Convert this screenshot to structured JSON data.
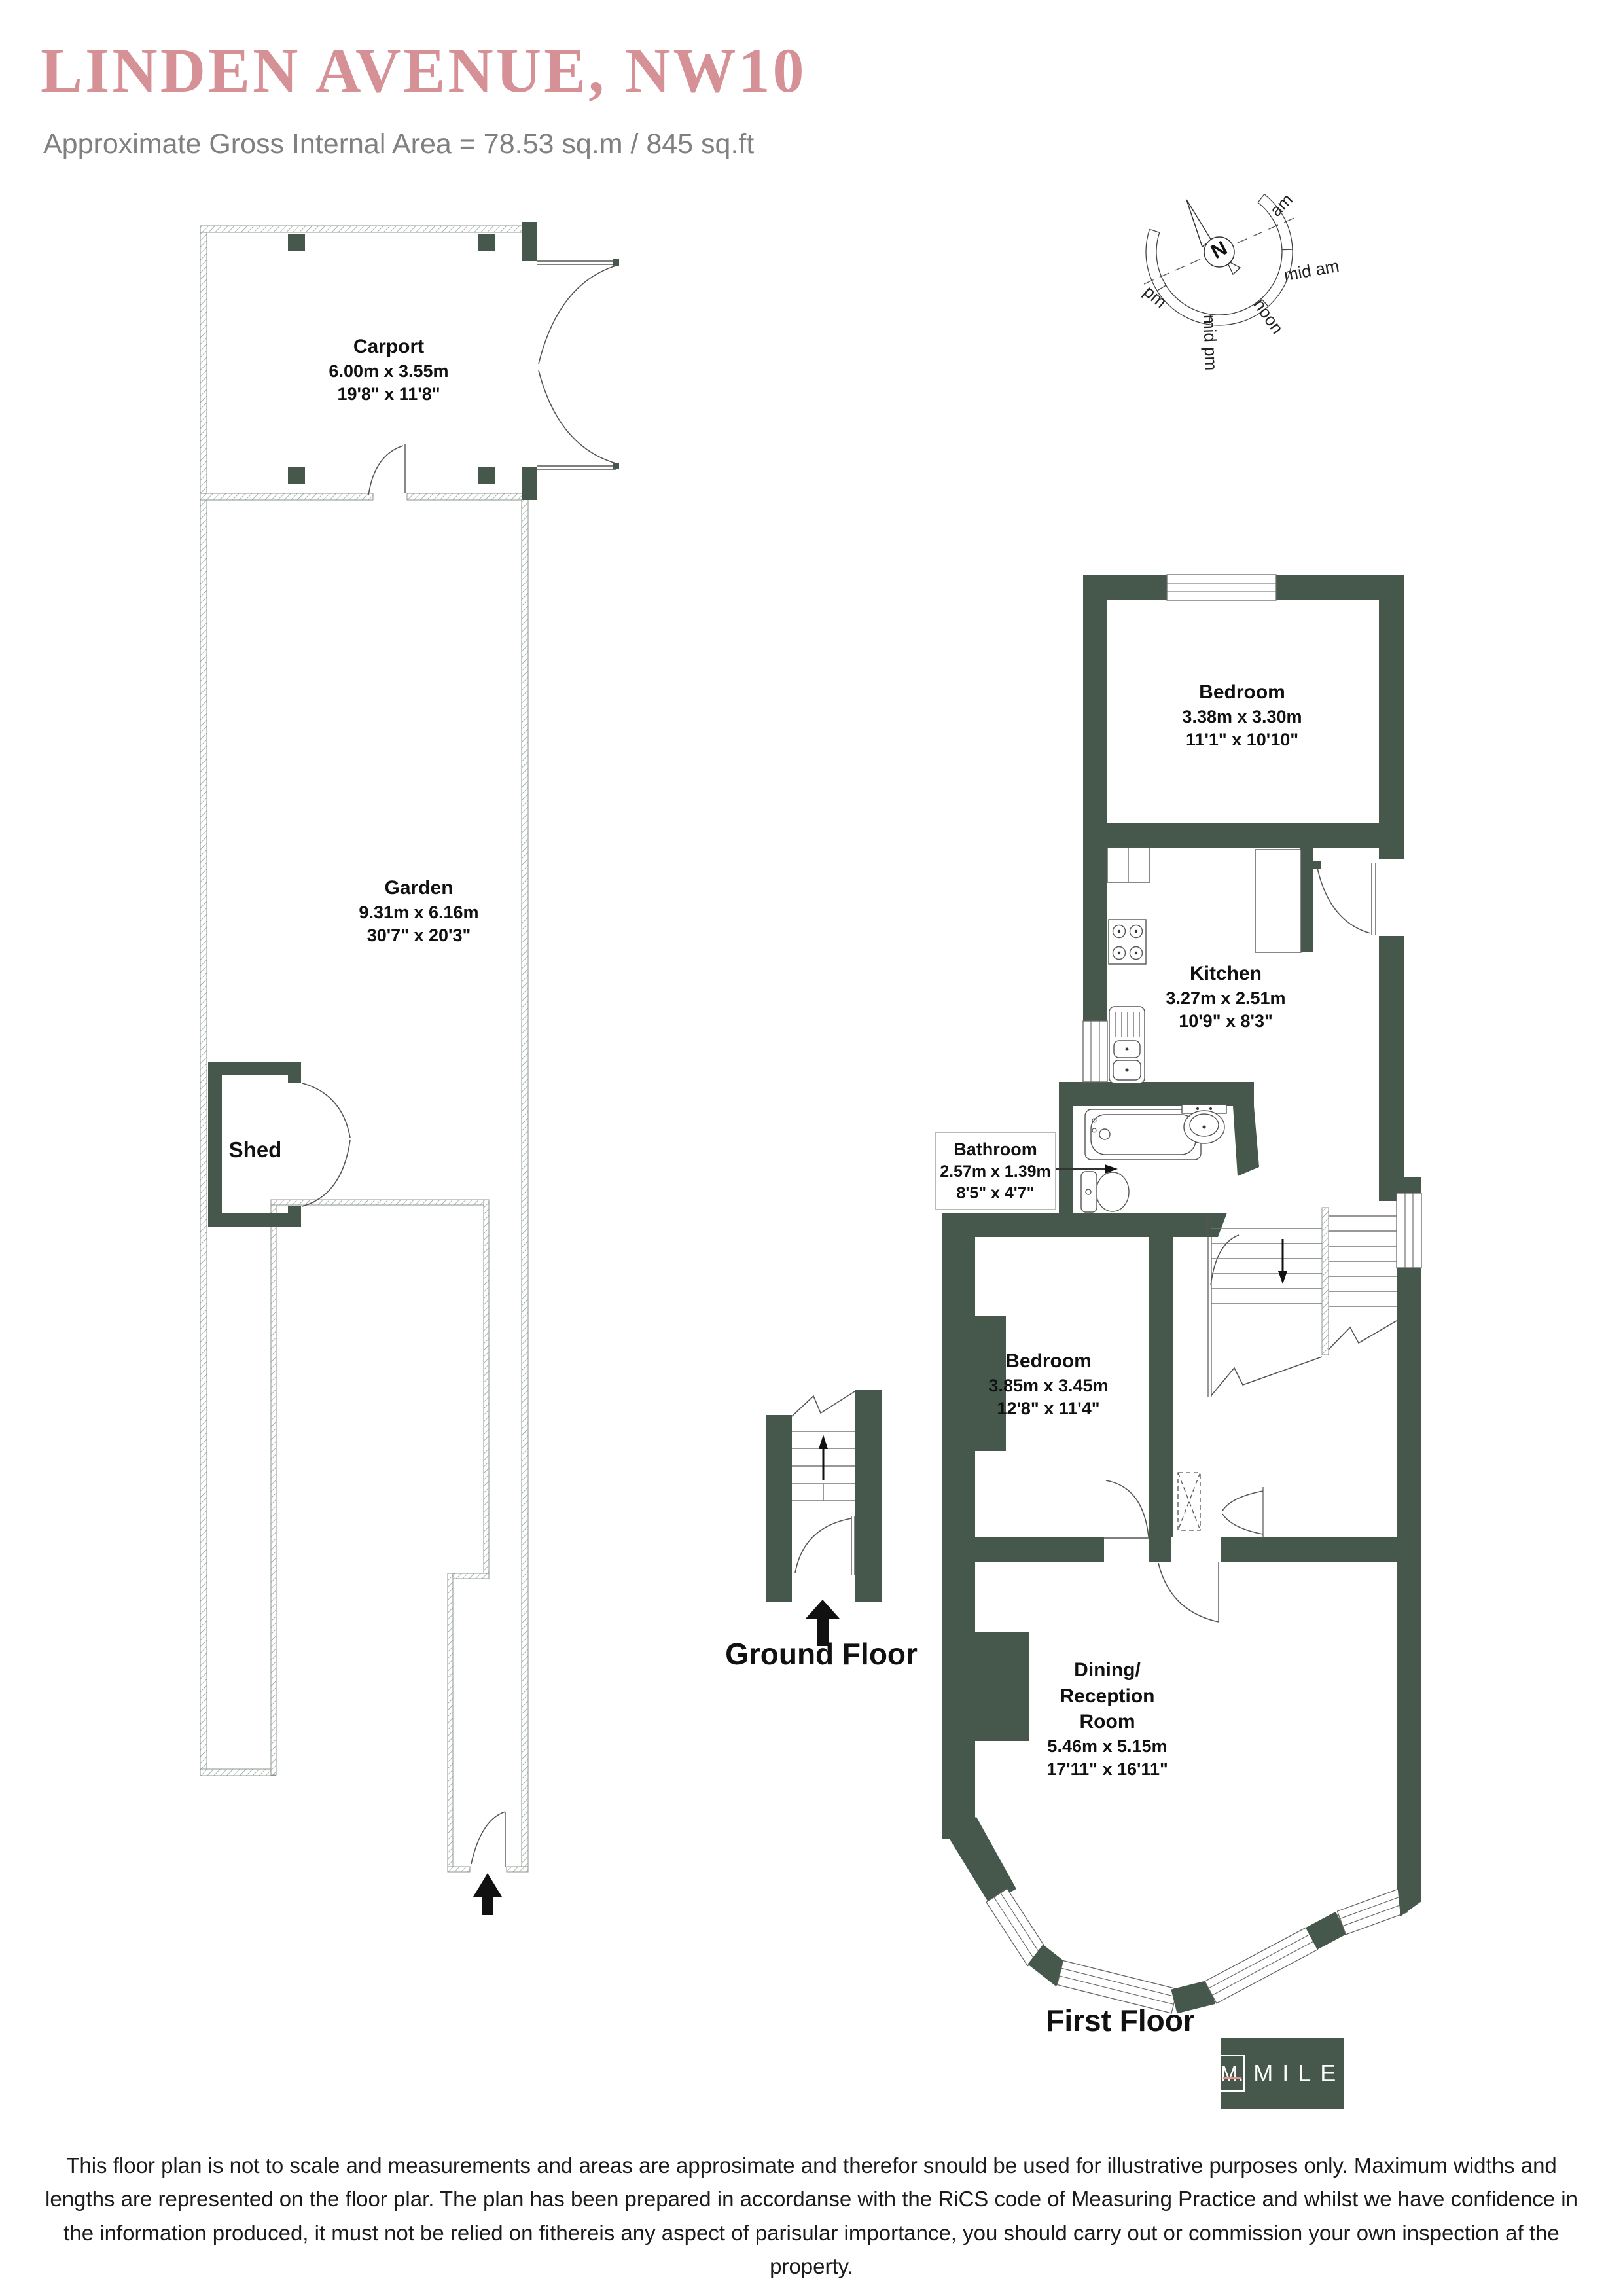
{
  "header": {
    "title": "LINDEN AVENUE, NW10",
    "subtitle": "Approximate Gross Internal Area = 78.53 sq.m / 845 sq.ft"
  },
  "compass": {
    "n": "N",
    "am": "am",
    "mid_am": "mid am",
    "noon": "noon",
    "mid_pm": "mid pm",
    "pm": "pm"
  },
  "rooms": {
    "carport": {
      "name": "Carport",
      "metric": "6.00m x 3.55m",
      "imperial": "19'8\" x 11'8\""
    },
    "garden": {
      "name": "Garden",
      "metric": "9.31m x 6.16m",
      "imperial": "30'7\" x 20'3\""
    },
    "shed": {
      "name": "Shed"
    },
    "bedroom_top": {
      "name": "Bedroom",
      "metric": "3.38m x 3.30m",
      "imperial": "11'1\" x 10'10\""
    },
    "kitchen": {
      "name": "Kitchen",
      "metric": "3.27m x 2.51m",
      "imperial": "10'9\" x 8'3\""
    },
    "bathroom": {
      "name": "Bathroom",
      "metric": "2.57m x 1.39m",
      "imperial": "8'5\" x 4'7\""
    },
    "bedroom_middle": {
      "name": "Bedroom",
      "metric": "3.85m x 3.45m",
      "imperial": "12'8\" x 11'4\""
    },
    "dining": {
      "name1": "Dining/",
      "name2": "Reception",
      "name3": "Room",
      "metric": "5.46m x 5.15m",
      "imperial": "17'11\" x 16'11\""
    }
  },
  "floors": {
    "ground": "Ground Floor",
    "first": "First Floor"
  },
  "logo": {
    "monogram": "M.",
    "brand": "MILE"
  },
  "disclaimer": {
    "line1": "This floor plan is not to scale and measurements and areas are approsimate and therefor snould be used for illustrative purposes only. Maximum widths and",
    "line2": "lengths are represented on the floor plar. The plan has been prepared in accordanse with the RiCS code of Measuring Practice and whilst we have confidence in",
    "line3": "the information produced, it must not be relied on fithereis any aspect of parisular importance, you should carry out or commission your own inspection af the",
    "line4": "property."
  },
  "colors": {
    "wall": "#46584b",
    "title": "#d59195",
    "logo_line": "#e39191"
  }
}
